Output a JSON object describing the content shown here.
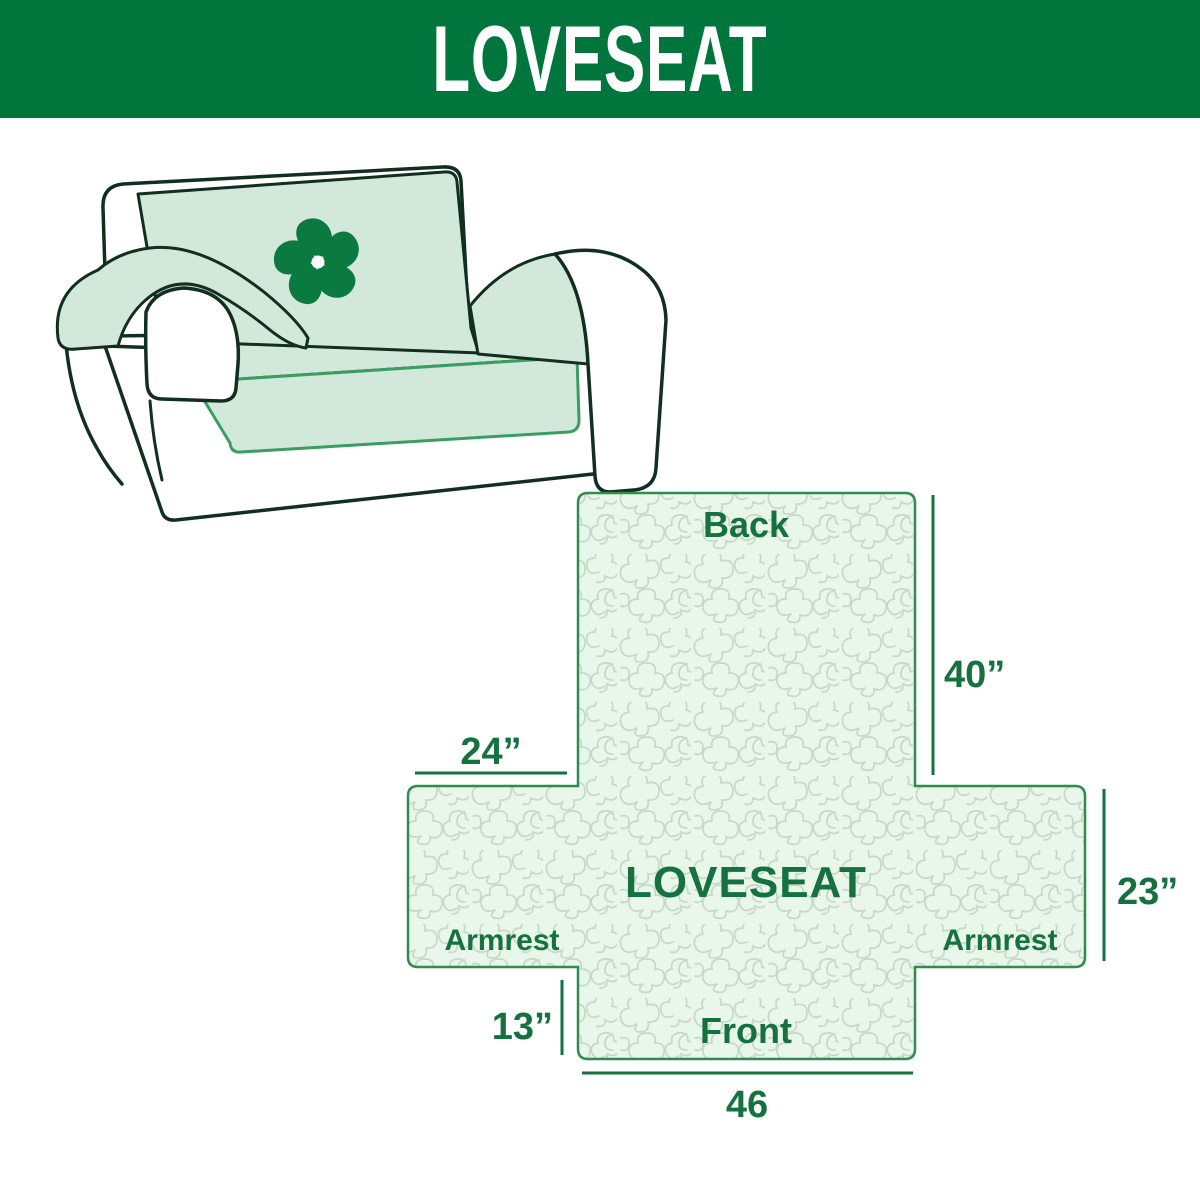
{
  "header": {
    "title": "LOVESEAT",
    "background_color": "#00753C",
    "text_color": "#FFFFFF"
  },
  "illustration": {
    "icon": "pinwheel-flower-logo-icon",
    "cover_color": "#D1E8DA",
    "outline_color": "#122E1E",
    "logo_color": "#0A7A41"
  },
  "diagram": {
    "center_label": "LOVESEAT",
    "labels": {
      "back": "Back",
      "front": "Front",
      "armrest_left": "Armrest",
      "armrest_right": "Armrest"
    },
    "dimensions": {
      "back_height": "40”",
      "armrest_top_width": "24”",
      "armrest_side_height": "23”",
      "front_skirt_height": "13”",
      "front_width": "46"
    },
    "colors": {
      "fill": "#E9F6EA",
      "pattern_line": "#C7D8C7",
      "border": "#2F8C4E",
      "label": "#15713F"
    }
  }
}
